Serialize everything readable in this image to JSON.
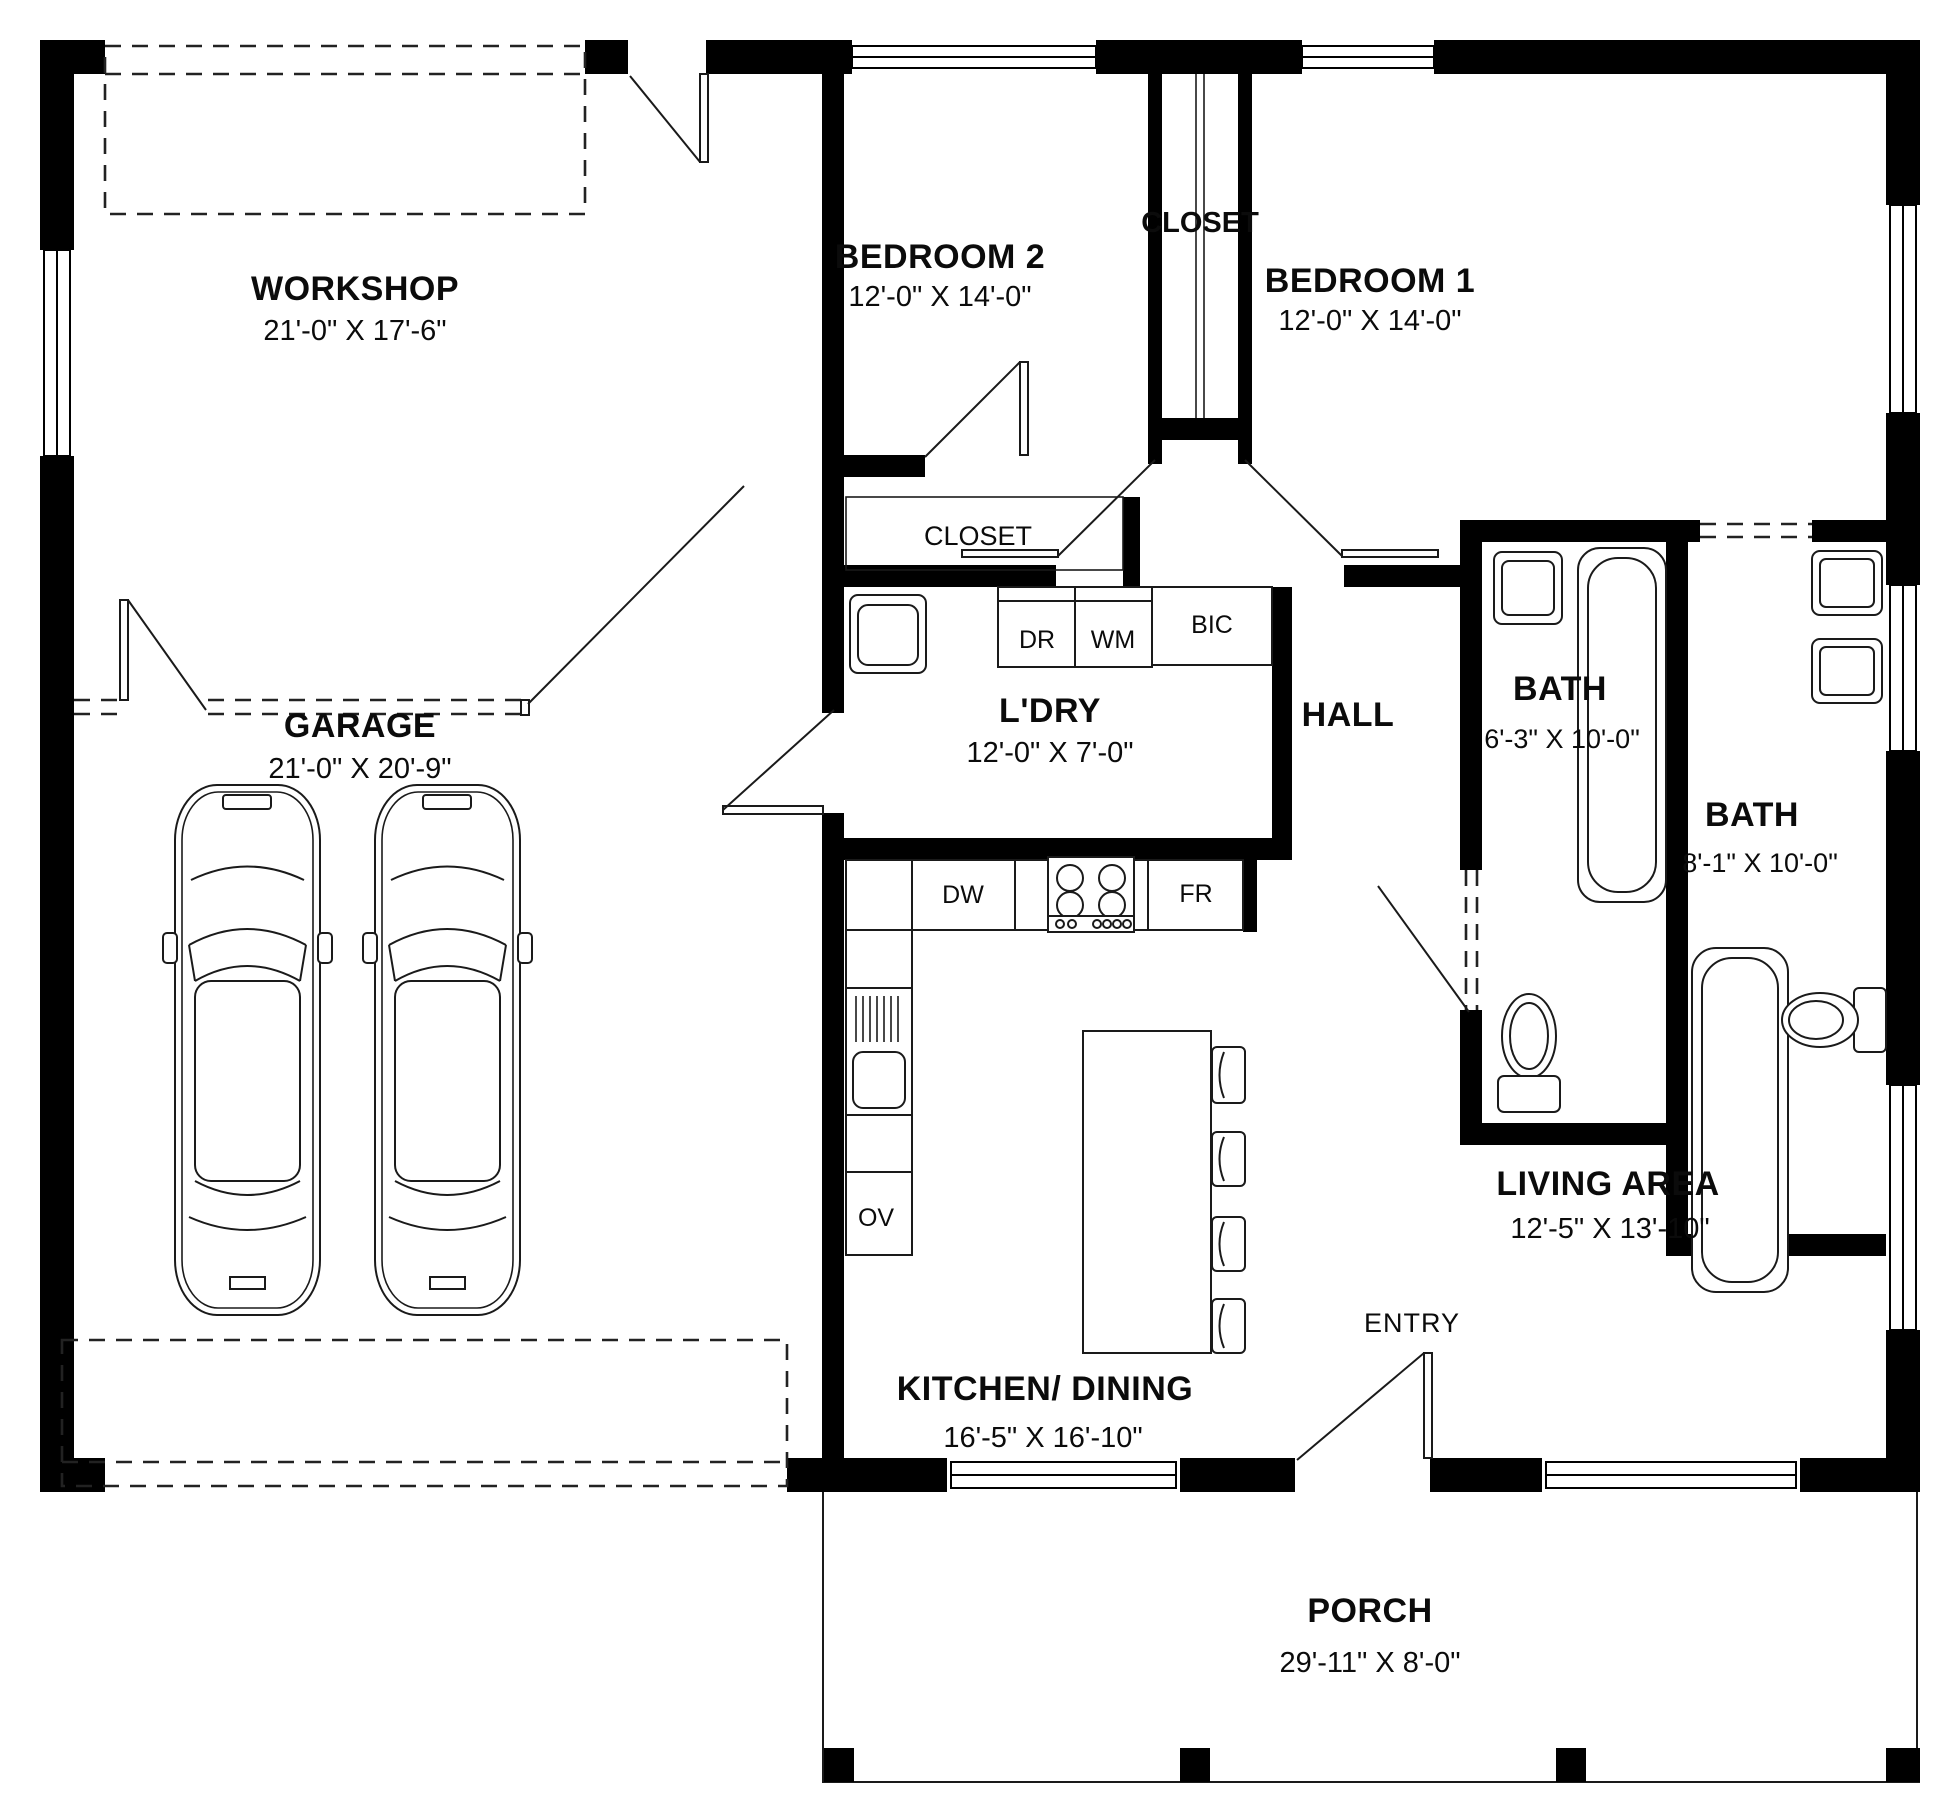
{
  "title": "House Floor Plan",
  "colors": {
    "wall": "#000000",
    "background": "#ffffff",
    "line": "#1a1a1a"
  },
  "rooms": {
    "workshop": {
      "name": "WORKSHOP",
      "dims": "21'-0\" X 17'-6\""
    },
    "garage": {
      "name": "GARAGE",
      "dims": "21'-0\" X 20'-9\""
    },
    "bedroom2": {
      "name": "BEDROOM 2",
      "dims": "12'-0\" X 14'-0\""
    },
    "bedroom1": {
      "name": "BEDROOM 1",
      "dims": "12'-0\" X 14'-0\""
    },
    "closet_top": {
      "name": "CLOSET"
    },
    "closet_laundry": {
      "name": "CLOSET"
    },
    "laundry": {
      "name": "L'DRY",
      "dims": "12'-0\" X 7'-0\""
    },
    "hall": {
      "name": "HALL"
    },
    "bath1": {
      "name": "BATH",
      "dims": "6'-3\" X 10'-0\""
    },
    "bath2": {
      "name": "BATH",
      "dims": "8'-1\" X 10'-0\""
    },
    "kitchen_dining": {
      "name": "KITCHEN/ DINING",
      "dims": "16'-5\" X 16'-10\""
    },
    "living_area": {
      "name": "LIVING AREA",
      "dims": "12'-5\" X 13'-10\""
    },
    "entry": {
      "name": "ENTRY"
    },
    "porch": {
      "name": "PORCH",
      "dims": "29'-11\" X 8'-0\""
    }
  },
  "appliances": {
    "dryer": "DR",
    "washer": "WM",
    "cupboard": "BIC",
    "dishwasher": "DW",
    "fridge": "FR",
    "oven": "OV"
  }
}
